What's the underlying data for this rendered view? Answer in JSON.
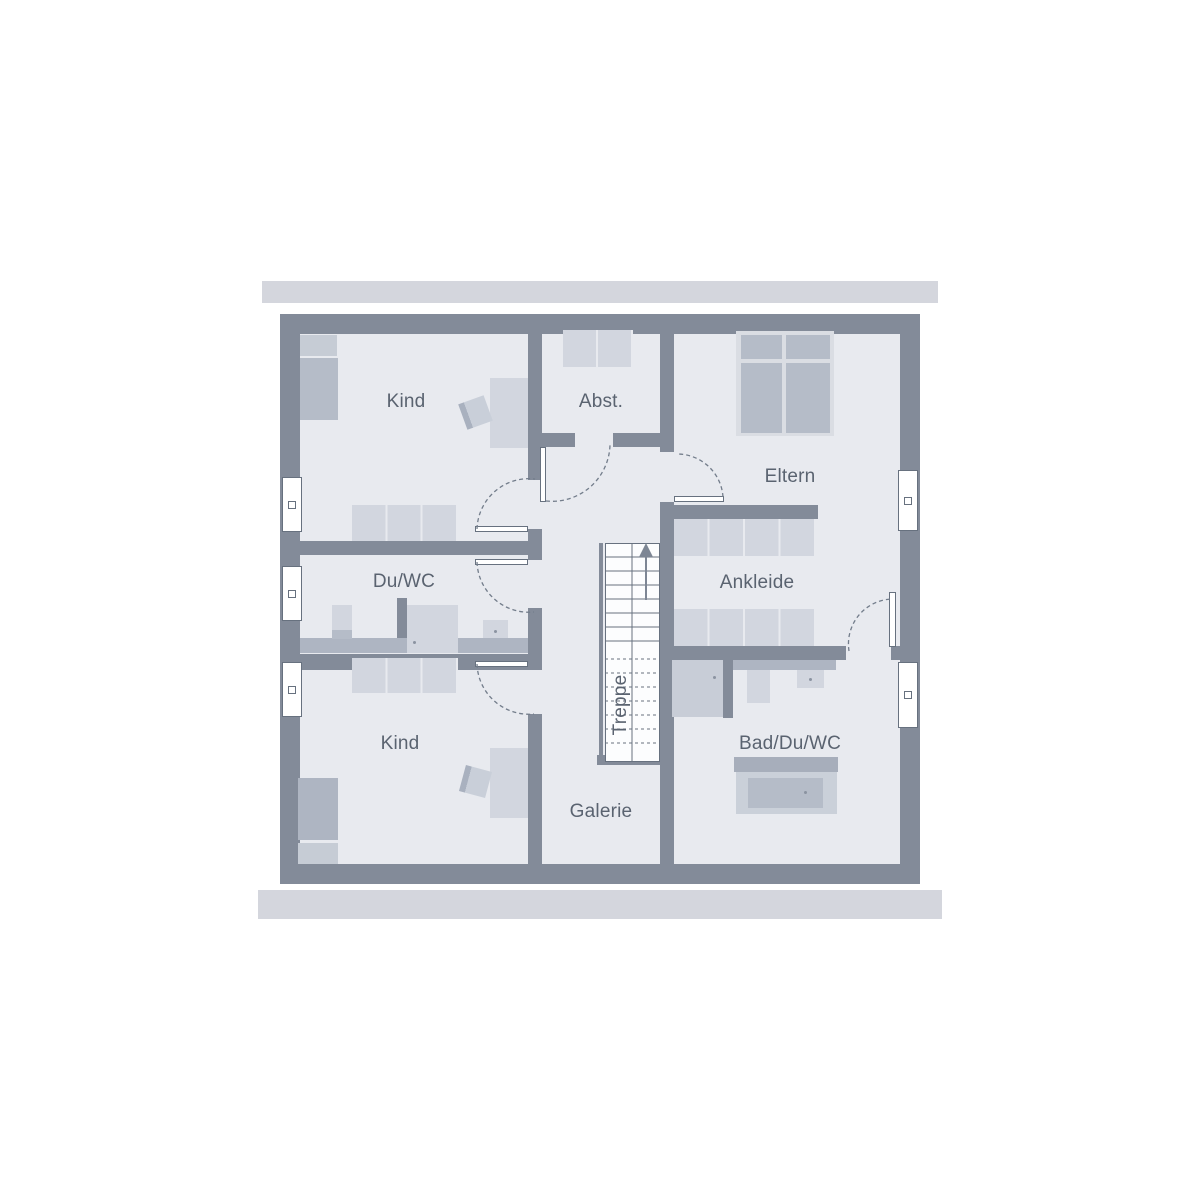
{
  "rooms": {
    "kind_top": {
      "label": "Kind"
    },
    "abst": {
      "label": "Abst."
    },
    "eltern": {
      "label": "Eltern"
    },
    "du_wc": {
      "label": "Du/WC"
    },
    "ankleide": {
      "label": "Ankleide"
    },
    "treppe": {
      "label": "Treppe"
    },
    "kind_bottom": {
      "label": "Kind"
    },
    "galerie": {
      "label": "Galerie"
    },
    "bad_du_wc": {
      "label": "Bad/Du/WC"
    }
  },
  "icons": {
    "stairs_direction": "arrow-up-icon"
  },
  "colors": {
    "wall": "#838b99",
    "floor": "#e8eaef",
    "bar": "#d4d6dd",
    "furnlight": "#d2d6df",
    "furnmid": "#b5bcc8",
    "band": "#aeb5c2",
    "deck": "#a7aebb",
    "pillow": "#c6ccd5",
    "frame": "#dadde3",
    "shower": "#c8cdd7",
    "tub": "#cad0d9",
    "line": "#67717f",
    "dash": "#737d8b",
    "text": "#5a6370"
  }
}
